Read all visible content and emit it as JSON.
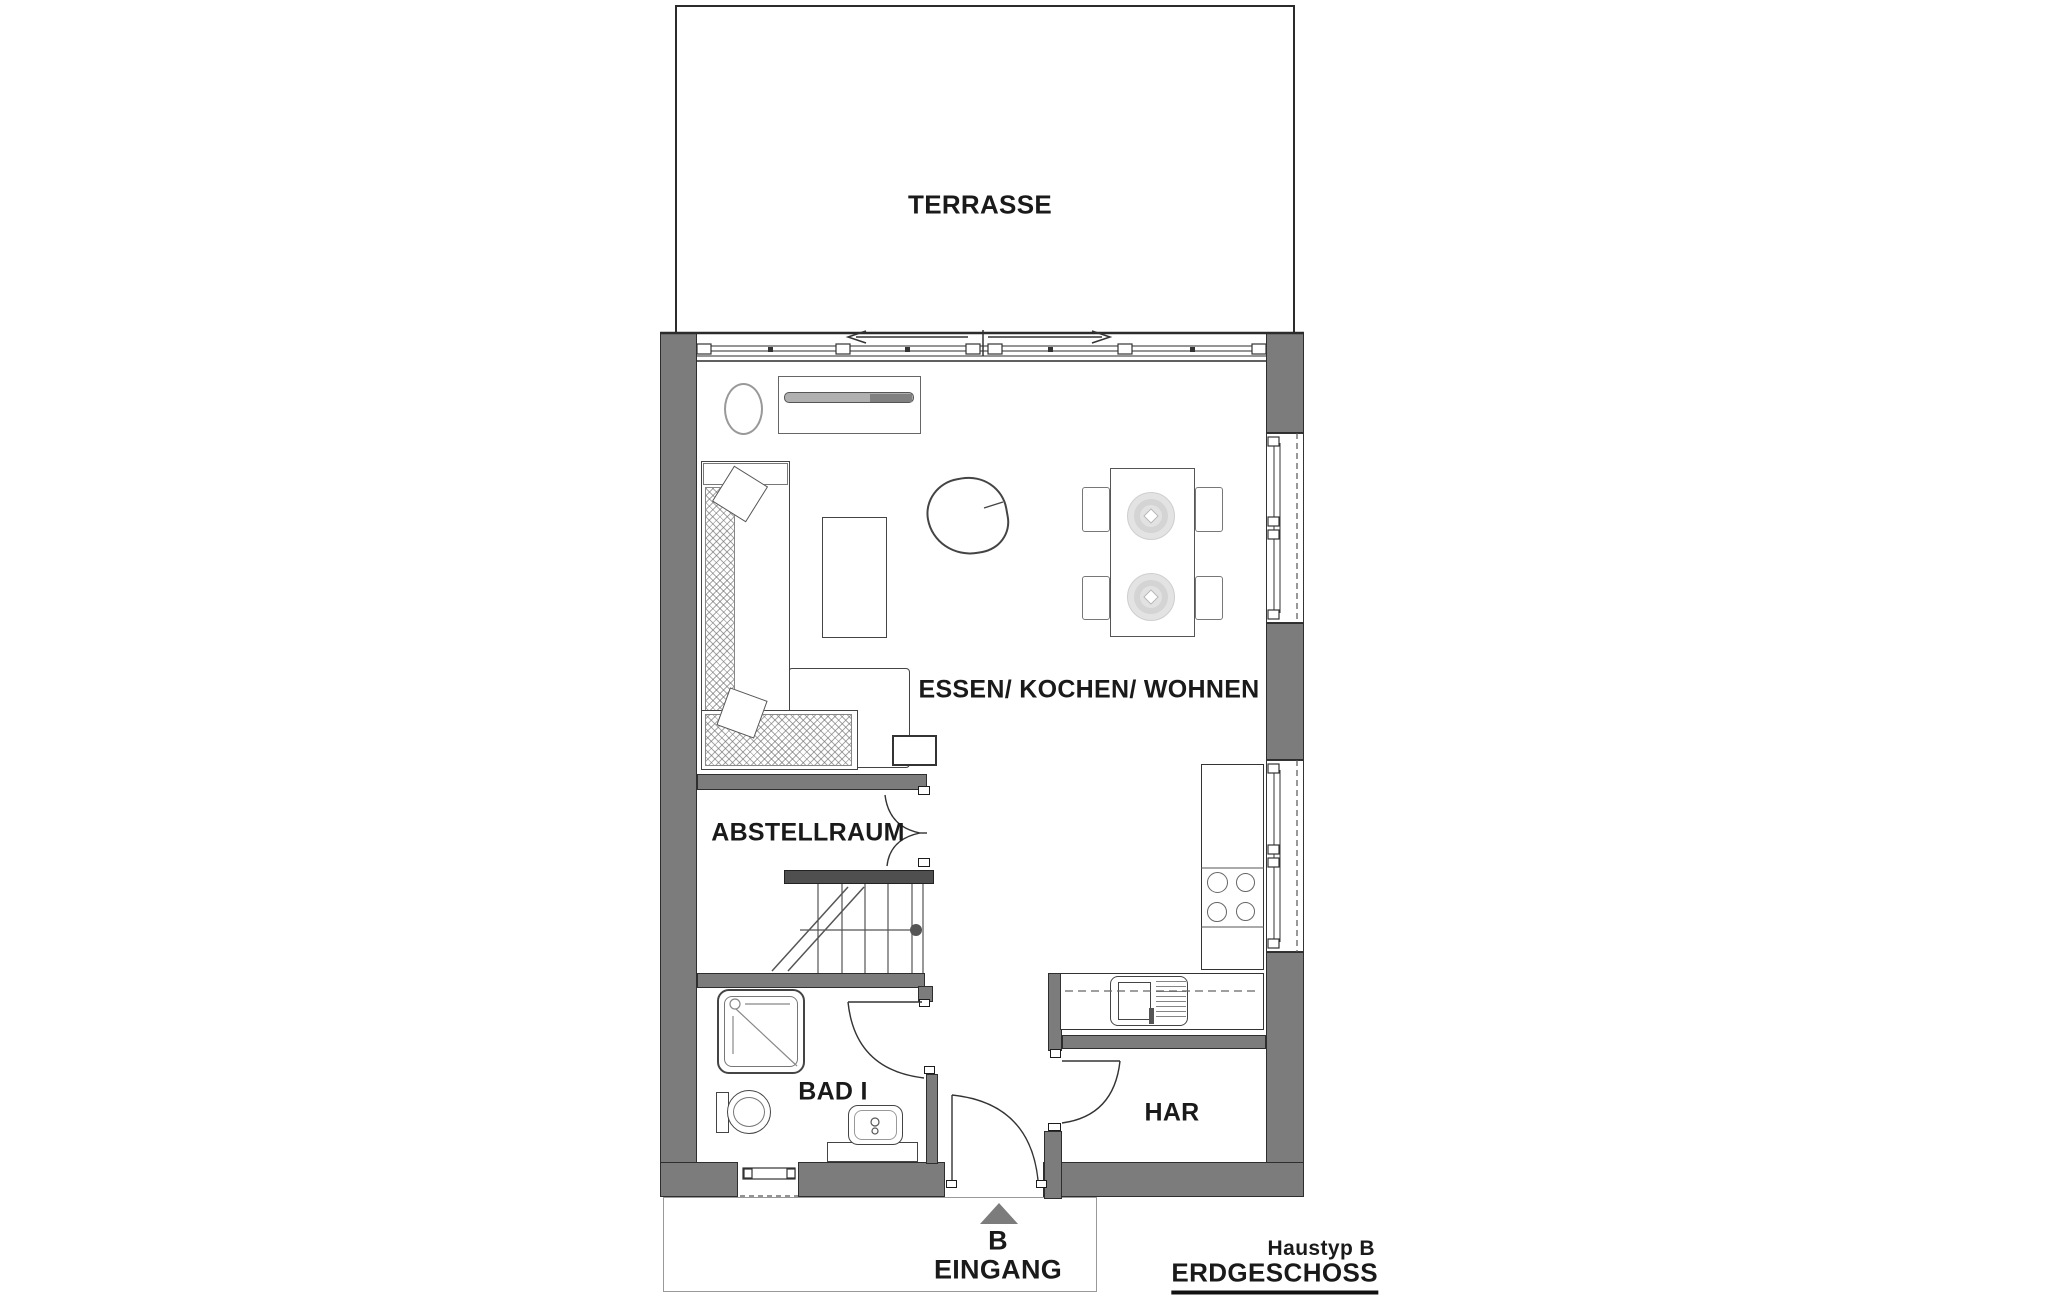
{
  "rooms": {
    "terrasse": "TERRASSE",
    "wohnen": "ESSEN/ KOCHEN/ WOHNEN",
    "abstellraum": "ABSTELLRAUM",
    "bad": "BAD I",
    "har": "HAR"
  },
  "entrance": {
    "marker": "B",
    "label": "EINGANG"
  },
  "titleblock": {
    "house_type": "Haustyp B",
    "floor": "ERDGESCHOSS"
  },
  "colors": {
    "wall": "#7c7c7c",
    "wall_dark": "#4f4f4f",
    "line": "#2b2b2b",
    "text": "#1a1a1a",
    "light_line": "#8a8a8a",
    "plate": "#e2e2e2"
  }
}
